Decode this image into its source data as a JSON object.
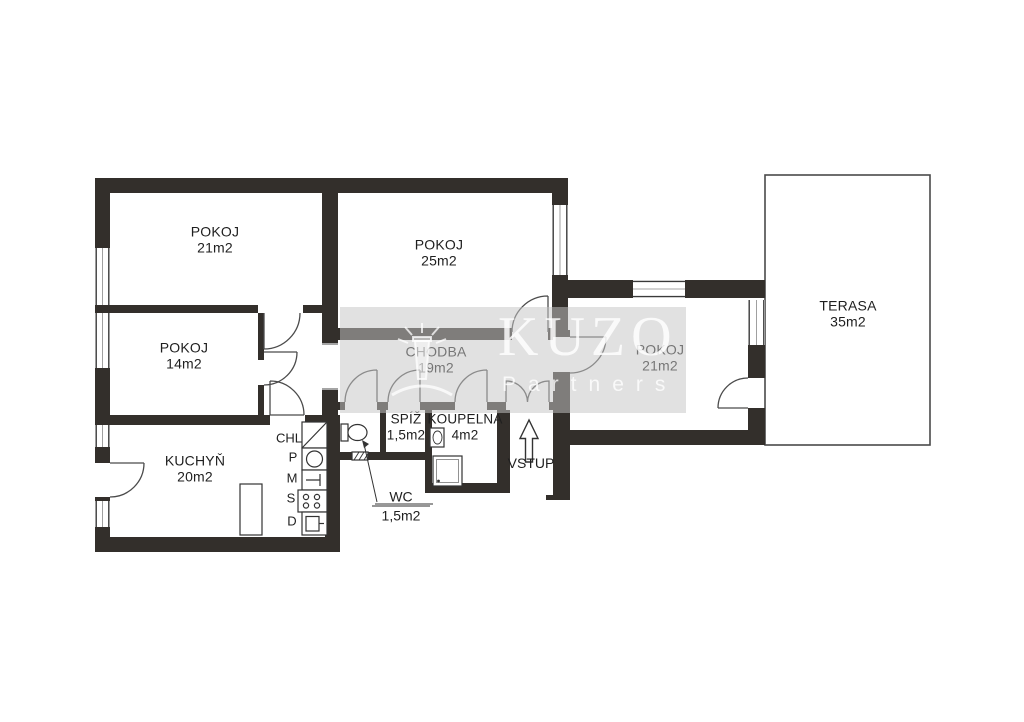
{
  "document": {
    "kind": "apartment floor plan (scanned)"
  },
  "rooms": {
    "pokoj_top_left": {
      "name": "POKOJ",
      "area": "21m2"
    },
    "pokoj_top_mid": {
      "name": "POKOJ",
      "area": "25m2"
    },
    "pokoj_mid_left": {
      "name": "POKOJ",
      "area": "14m2"
    },
    "chodba": {
      "name": "CHODBA",
      "area": "19m2"
    },
    "pokoj_east": {
      "name": "POKOJ",
      "area": "21m2"
    },
    "terasa": {
      "name": "TERASA",
      "area": "35m2"
    },
    "kuchyn": {
      "name": "KUCHYŇ",
      "area": "20m2"
    },
    "spiz": {
      "name": "SPÍŽ",
      "area": "1,5m2"
    },
    "koupelna": {
      "name": "KOUPELNA",
      "area": "4m2"
    },
    "wc": {
      "name": "WC",
      "area": "1,5m2"
    }
  },
  "annotations": {
    "entrance": "VSTUP",
    "fridge": "CHL",
    "appliance_letters": [
      "P",
      "M",
      "S",
      "D"
    ]
  },
  "watermark": {
    "brand": "KUZO",
    "subbrand": "Partners"
  },
  "colors": {
    "wall": "#332f2b",
    "line": "#4b4b4b",
    "text": "#1f1f1f"
  }
}
